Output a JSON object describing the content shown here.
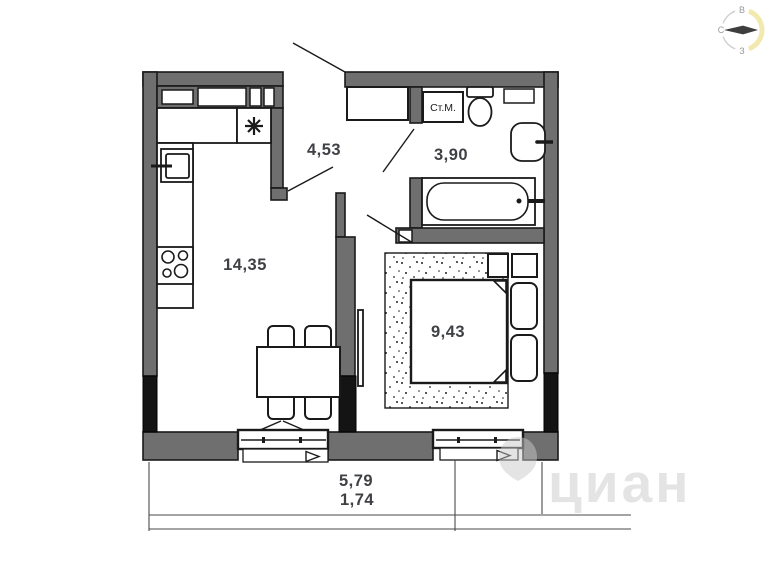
{
  "compass": {
    "top": "В",
    "left": "С",
    "bottom": "З"
  },
  "rooms": {
    "kitchen_living": {
      "area": "14,35"
    },
    "hallway": {
      "area": "4,53"
    },
    "bathroom": {
      "area": "3,90"
    },
    "bedroom": {
      "area": "9,43"
    }
  },
  "labels": {
    "washing_machine": "Ст.М."
  },
  "dimensions": {
    "width": "5,79",
    "secondary": "1,74"
  },
  "watermark": {
    "text": "циан"
  },
  "colors": {
    "wall": "#6f6f6f",
    "wall_dark": "#141414",
    "line": "#1a1a1a",
    "label": "#3f4145",
    "compass_accent": "#f1e9ad",
    "watermark": "#c9c9c9"
  }
}
